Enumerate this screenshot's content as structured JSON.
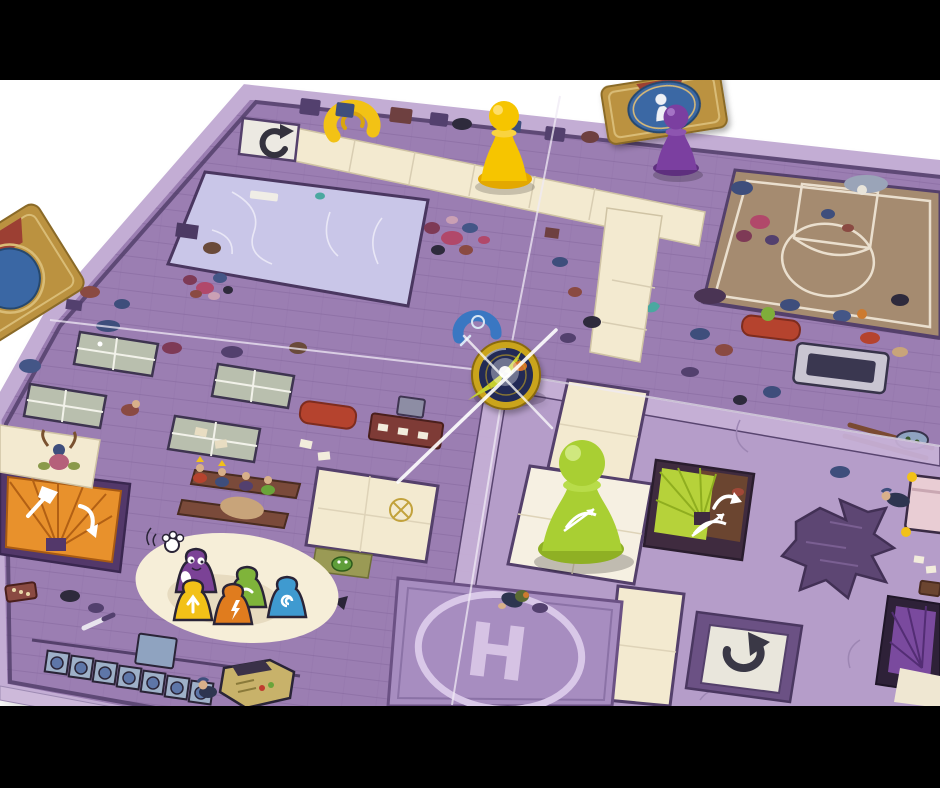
{
  "scene": {
    "description": "Photograph of a purple cartoon school/mall board game on a white table, letterboxed in black",
    "helipad_letter": "H"
  },
  "palette": {
    "background": "#ffffff",
    "letterbox": "#000000",
    "board_floor": "#9b7eb2",
    "board_floor_light": "#b59dc9",
    "board_rim": "#c3add4",
    "wall_dark": "#54406b",
    "corridor_cream": "#f3ead0",
    "tile_white": "#f6f0e2",
    "rink_blue": "#c9c6e8",
    "court_tan": "#a58b70",
    "court_line": "#eadfce",
    "pawn_yellow": "#f6c500",
    "pawn_purple": "#7b3fa0",
    "pawn_green": "#a9cf33",
    "token_gold": "#caa41f",
    "token_navy": "#202c54",
    "card_gold": "#bb9240",
    "card_blue": "#3a67a4",
    "card_red": "#9c3f33",
    "stair_orange": "#e8912c",
    "stair_lime": "#b6d23a",
    "stair_purple": "#7a4a9e",
    "splat": "#5d4673",
    "helipad_pad": "#a78dc0",
    "helipad_line": "#d9c8e8",
    "icon_dark": "#3a3846",
    "icon_white": "#ffffff",
    "table_green": "#b9bfae",
    "couch_red": "#b5432e",
    "locker_blue": "#9eb0c8",
    "booth_khaki": "#c8b26a"
  },
  "pieces": {
    "yellow_pawn": {
      "label": "yellow pawn",
      "color": "#f6c500"
    },
    "purple_pawn": {
      "label": "purple pawn",
      "color": "#7b3fa0"
    },
    "green_pawn": {
      "label": "green pawn with bow-and-arrow icon",
      "color": "#a9cf33"
    },
    "compass_token": {
      "label": "gold compass token at board center",
      "ring": "#caa41f",
      "face": "#202c54"
    }
  },
  "cards": {
    "top_right": {
      "label": "gold character card with blue oval and white pawn"
    },
    "left_edge": {
      "label": "gold character card, partially visible at left edge"
    }
  },
  "icons": {
    "rotate_ccw": "counterclockwise rotate arrow tile",
    "rotate_cw": "clockwise rotate arrow tile",
    "magnet_yellow": "yellow horseshoe icon",
    "magnet_blue": "blue horseshoe swirl icon",
    "bow": "white bow-and-arrow icon",
    "axe": "white axe icon",
    "crosshair": "gold circle-cross mark"
  },
  "rooms": {
    "ice_rink": "icy blue rink with crowds",
    "basketball_court": "tan basketball court",
    "ping_pong": "room with four ping-pong tables",
    "helipad": "purple helipad with letter H",
    "pawn_mural": "cartoon pawns painted on cream blob"
  }
}
